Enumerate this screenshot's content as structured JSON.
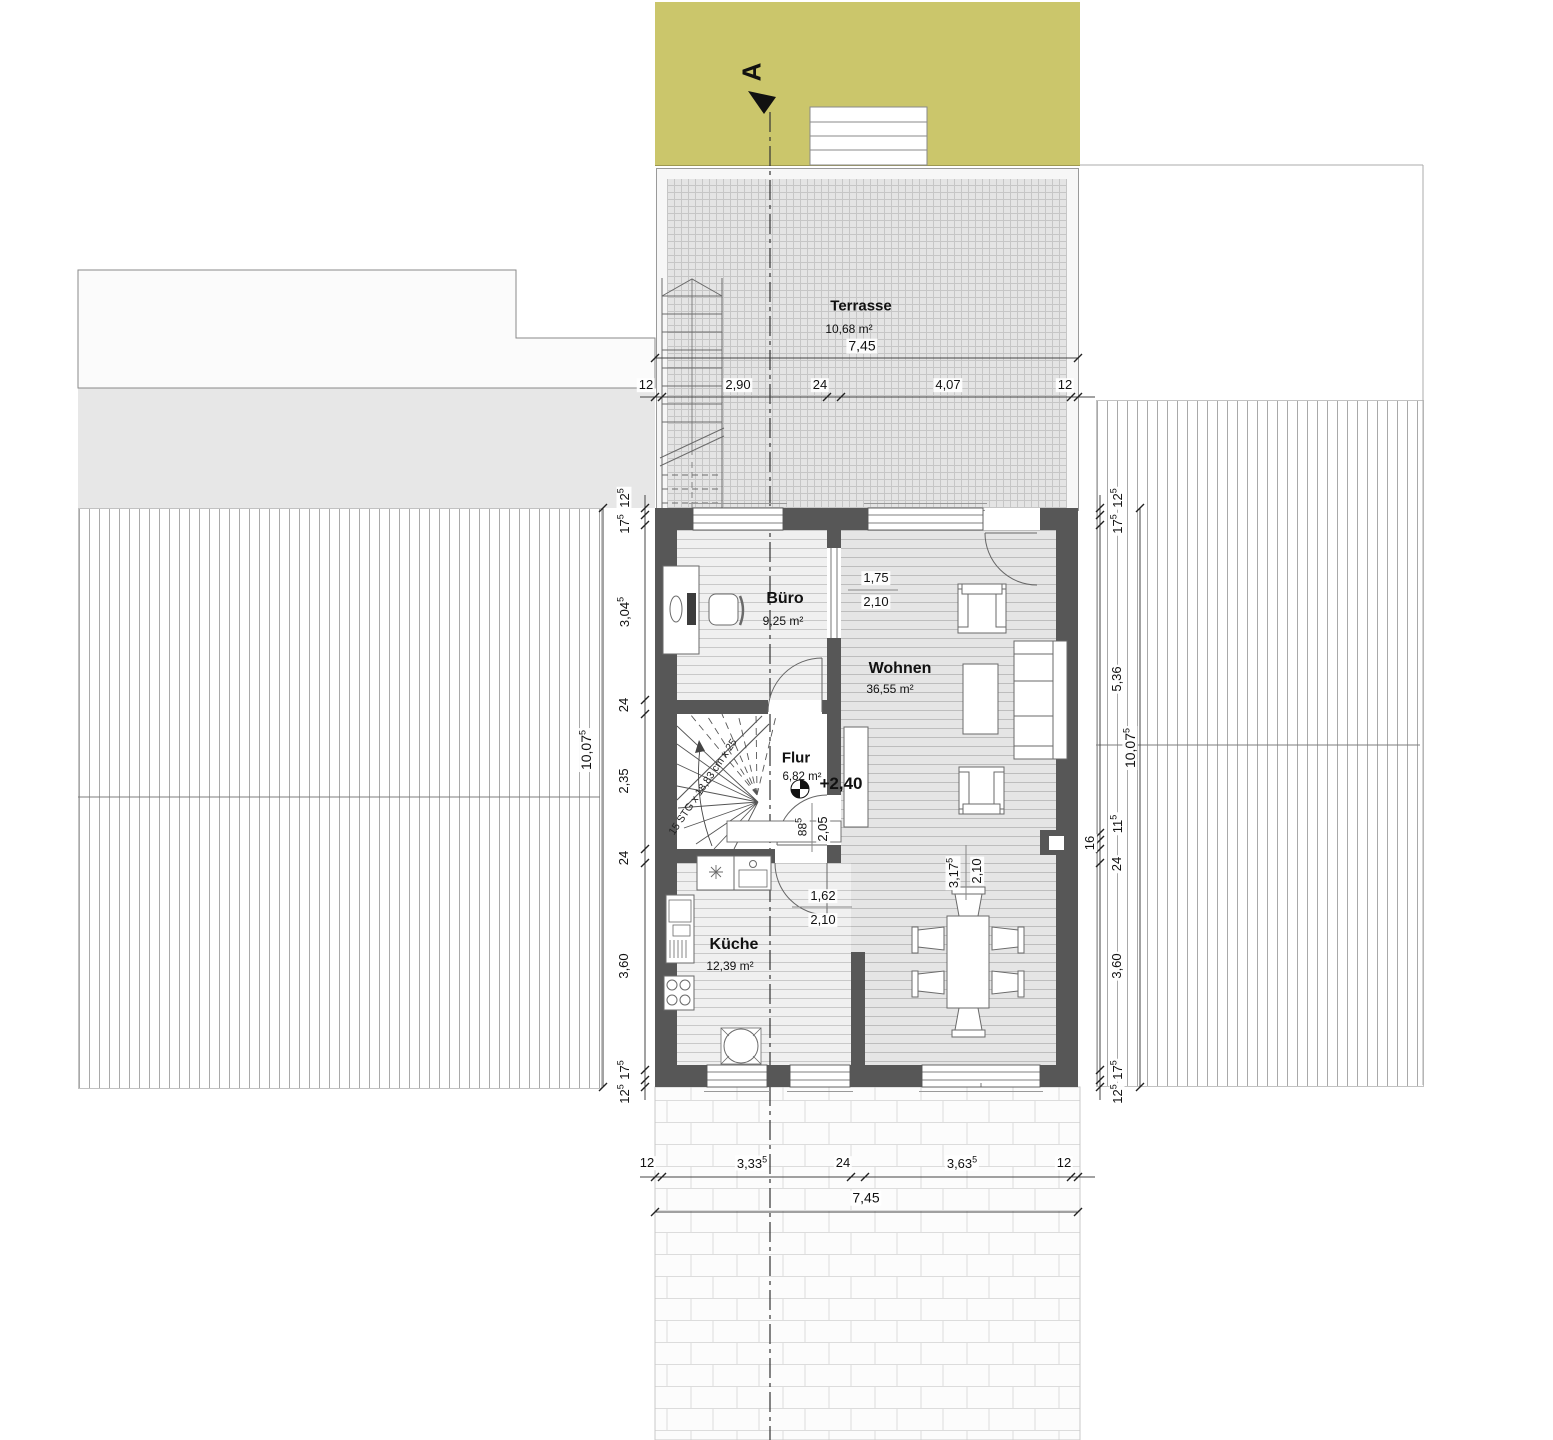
{
  "plan": {
    "section": {
      "label": "A"
    },
    "level": {
      "label": "+2,40"
    },
    "stair": {
      "note": "15 STG x 18,83 cm x 25"
    },
    "rooms": {
      "terrasse": {
        "name": "Terrasse",
        "area": "10,68 m²"
      },
      "buero": {
        "name": "Büro",
        "area": "9,25 m²"
      },
      "wohnen": {
        "name": "Wohnen",
        "area": "36,55 m²"
      },
      "flur": {
        "name": "Flur",
        "area": "6,82 m²"
      },
      "kueche": {
        "name": "Küche",
        "area": "12,39 m²"
      }
    },
    "openings": {
      "buero_wohnen": {
        "w": "1,75",
        "h": "2,10"
      },
      "kueche_ess": {
        "w": "1,62",
        "h": "2,10"
      },
      "flur_door": {
        "wv": "88",
        "ws": "5",
        "h": "2,05"
      },
      "wohnen_ess": {
        "wv": "3,17",
        "ws": "5",
        "h": "2,10"
      }
    },
    "dims": {
      "top": {
        "total": {
          "v": "7,45"
        },
        "parts": [
          {
            "v": "12"
          },
          {
            "v": "2,90"
          },
          {
            "v": "24"
          },
          {
            "v": "4,07"
          },
          {
            "v": "12"
          }
        ]
      },
      "bottom": {
        "total": {
          "v": "7,45"
        },
        "parts": [
          {
            "v": "12"
          },
          {
            "v": "3,33",
            "s": "5"
          },
          {
            "v": "24"
          },
          {
            "v": "3,63",
            "s": "5"
          },
          {
            "v": "12"
          }
        ]
      },
      "left": {
        "total": {
          "v": "10,07",
          "s": "5"
        },
        "parts": [
          {
            "v": "12",
            "s": "5"
          },
          {
            "v": "17",
            "s": "5"
          },
          {
            "v": "3,04",
            "s": "5"
          },
          {
            "v": "24"
          },
          {
            "v": "2,35"
          },
          {
            "v": "24"
          },
          {
            "v": "3,60"
          },
          {
            "v": "17",
            "s": "5"
          },
          {
            "v": "12",
            "s": "5"
          }
        ]
      },
      "right": {
        "total": {
          "v": "10,07",
          "s": "5"
        },
        "parts": [
          {
            "v": "12",
            "s": "5"
          },
          {
            "v": "17",
            "s": "5"
          },
          {
            "v": "5,36"
          },
          {
            "v": "11",
            "s": "5"
          },
          {
            "v": "16"
          },
          {
            "v": "24"
          },
          {
            "v": "3,60"
          },
          {
            "v": "17",
            "s": "5"
          },
          {
            "v": "12",
            "s": "5"
          }
        ]
      }
    },
    "colors": {
      "garden_band": "#cbc66b",
      "walls": "#575757",
      "terrace_fill": "#e4e4e4"
    }
  }
}
